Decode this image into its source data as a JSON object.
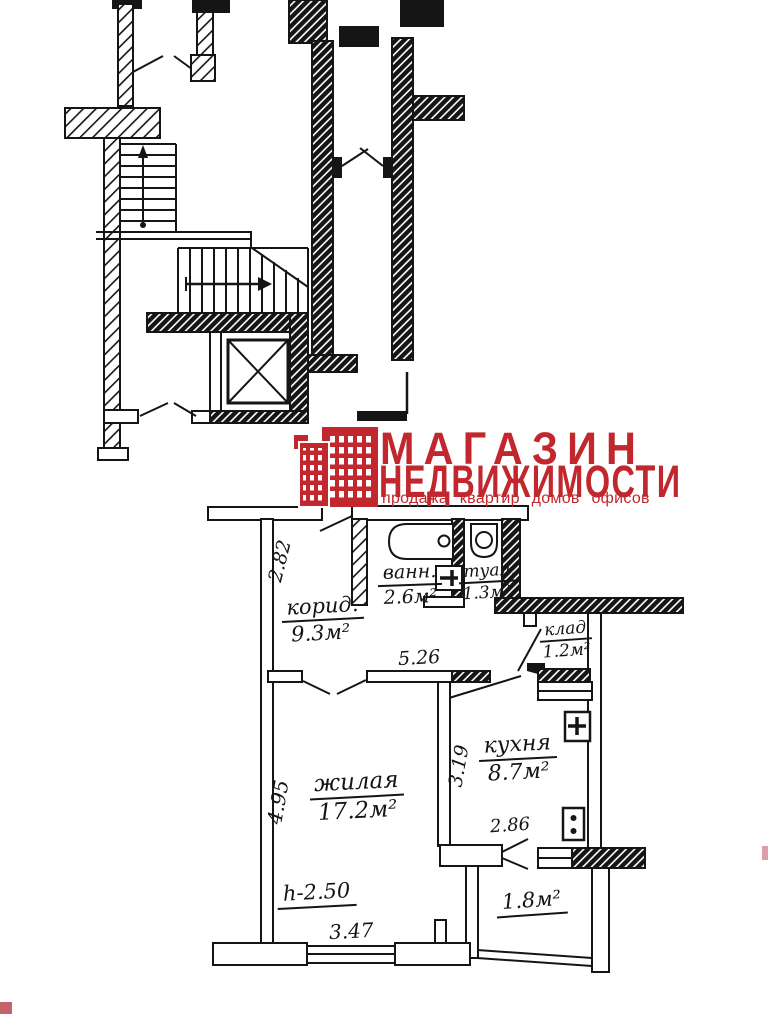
{
  "logo": {
    "brand_color": "#c1272d",
    "icon": "building-icon",
    "title_line1": "МАГАЗИН",
    "title_line2": "НЕДВИЖИМОСТИ",
    "tagline": "продажа квартир домов офисов"
  },
  "floor_plan": {
    "rooms": {
      "bathroom": {
        "name": "ванн.",
        "area": "2.6м²"
      },
      "toilet": {
        "name": "туал.",
        "area": "1.3м²"
      },
      "corridor": {
        "name": "корид.",
        "area": "9.3м²"
      },
      "closet": {
        "name": "клад",
        "area": "1.2м²"
      },
      "kitchen": {
        "name": "кухня",
        "area": "8.7м²"
      },
      "living_room": {
        "name": "жилая",
        "area": "17.2м²"
      },
      "balcony": {
        "area": "1.8м²"
      }
    },
    "dimensions": {
      "corridor_depth": "2.82",
      "corridor_width": "5.26",
      "living_depth": "4.95",
      "kitchen_depth": "3.19",
      "kitchen_width": "2.86",
      "living_width": "3.47",
      "ceiling_height": "h-2.50"
    }
  }
}
